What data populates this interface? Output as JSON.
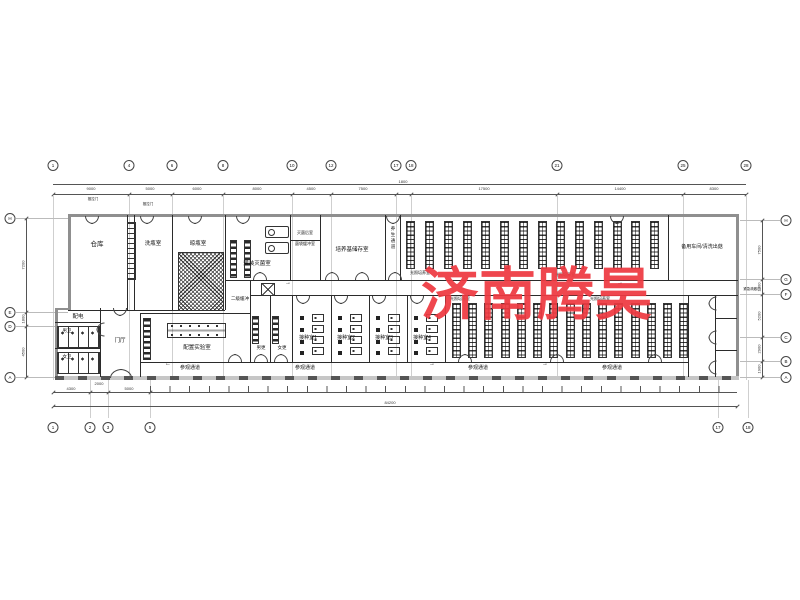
{
  "watermark": "济南腾昊",
  "rooms": {
    "cangku": "仓库",
    "xiping": "洗瓶室",
    "liangping": "晾瓶室",
    "guanzhuang": "灌装灭菌室",
    "miejunhou": "灭菌后室",
    "jundaihc": "菌袋缓冲室",
    "peiyangji": "培养基储存室",
    "yangsheng": "养生通道",
    "guangzhao": "光照培养室",
    "beiyong": "备用车间/清洗出菇",
    "erjihc": "二级缓冲",
    "peidian": "配电",
    "nanwei": "男卫",
    "nvwei": "女卫",
    "menting": "门厅",
    "peizhi": "配置实验室",
    "nangeng": "男更",
    "nvgeng": "女更",
    "jiezhong1": "接种室1",
    "jiezhong2": "接种室2",
    "jiezhong3": "接种室3",
    "jiezhong4": "接种室4",
    "canguan": "参观通道",
    "tuila": "推拉门",
    "jinji": "紧急疏散口"
  },
  "grid": {
    "top": [
      "1",
      "4",
      "6",
      "8",
      "10",
      "12",
      "17",
      "18",
      "21",
      "25",
      "28"
    ],
    "bottom": [
      "1",
      "2",
      "3",
      "5",
      "17",
      "18"
    ],
    "left": [
      "H",
      "E",
      "D",
      "A"
    ],
    "right": [
      "H",
      "G",
      "F",
      "C",
      "B",
      "A"
    ]
  },
  "dims": {
    "top": [
      "9000",
      "5000",
      "6000",
      "8000",
      "4500",
      "7500",
      "1800",
      "17500",
      "14400",
      "8300"
    ],
    "left": [
      "7200",
      "1800",
      "4500"
    ],
    "right": [
      "7500",
      "1800",
      "5200",
      "2900",
      "1900"
    ],
    "bottom_left": [
      "4300",
      "2000",
      "5000"
    ],
    "total": "84200"
  },
  "symbols": {
    "arrow_right": "→",
    "arrow_left": "←"
  }
}
